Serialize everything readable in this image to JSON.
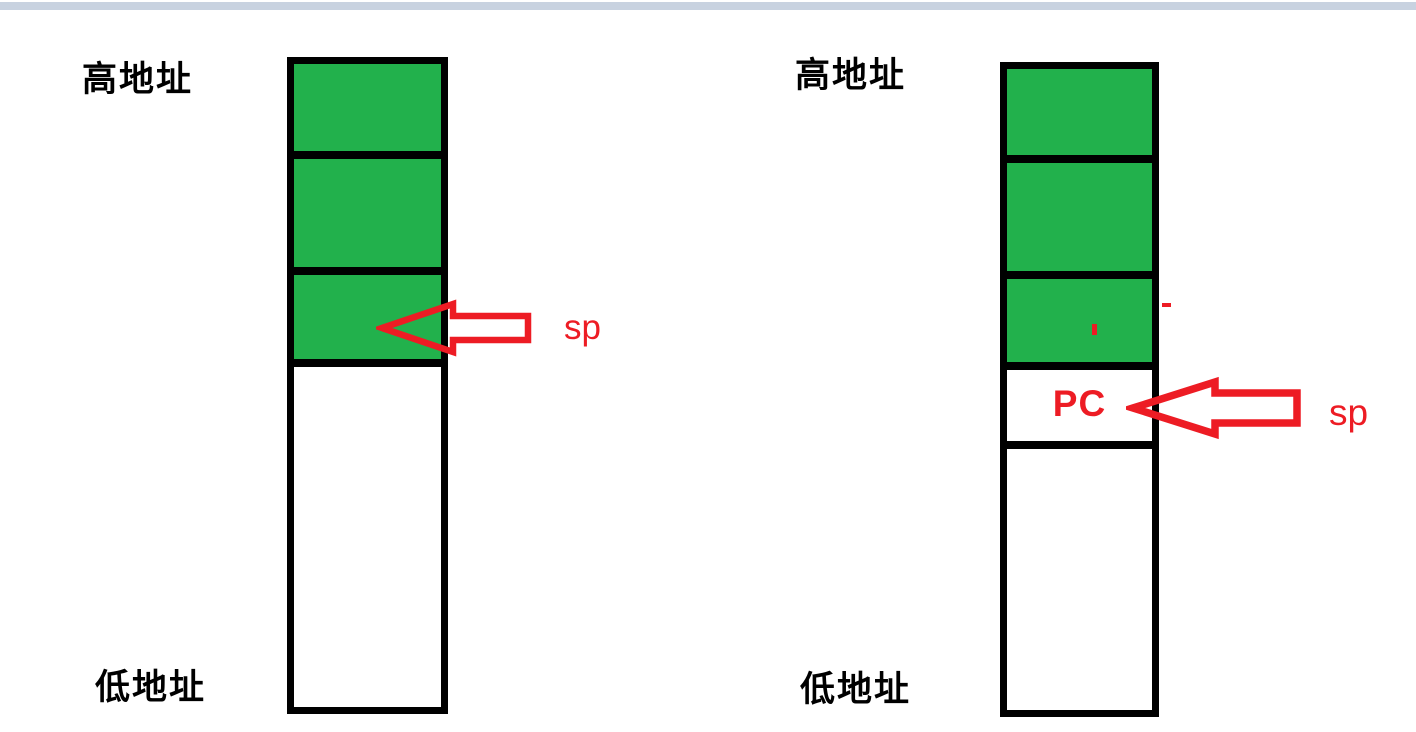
{
  "page": {
    "top_bar_color": "#c8d2e0",
    "background": "#ffffff"
  },
  "colors": {
    "stack_fill_green": "#22b14c",
    "stack_border_black": "#000000",
    "pointer_red": "#ed1c24"
  },
  "left_diagram": {
    "high_address_label": "高地址",
    "low_address_label": "低地址",
    "sp_label": "sp",
    "stack": {
      "filled_green_cells": 3,
      "empty_white_cells": 1,
      "sp_points_to": "lowest green (occupied) cell"
    }
  },
  "right_diagram": {
    "high_address_label": "高地址",
    "low_address_label": "低地址",
    "sp_label": "sp",
    "pc_label": "PC",
    "stack": {
      "filled_green_cells": 3,
      "pc_cell": "PC",
      "empty_white_cells": 1,
      "sp_points_to": "PC cell pushed below green cells"
    }
  }
}
